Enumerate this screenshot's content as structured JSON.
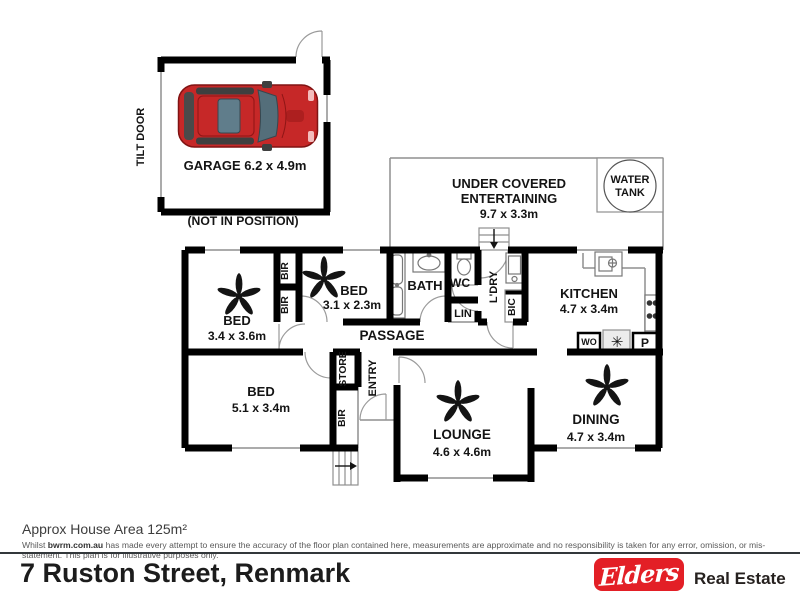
{
  "colors": {
    "wall": "#000000",
    "thin_line": "#8f8f8f",
    "car_red": "#c62828",
    "brand_red": "#e31f26",
    "divider": "#33383b"
  },
  "garage": {
    "label": "GARAGE 6.2 x 4.9m",
    "door": "TILT DOOR",
    "note": "(NOT IN POSITION)"
  },
  "outdoor": {
    "entertaining_line1": "UNDER COVERED",
    "entertaining_line2": "ENTERTAINING",
    "entertaining_dims": "9.7 x 3.3m",
    "water_tank_line1": "WATER",
    "water_tank_line2": "TANK"
  },
  "rooms": {
    "bed1_name": "BED",
    "bed1_dims": "3.4 x 3.6m",
    "bed2_name": "BED",
    "bed2_dims": "3.1 x 2.3m",
    "bed3_name": "BED",
    "bed3_dims": "5.1 x 3.4m",
    "lounge_name": "LOUNGE",
    "lounge_dims": "4.6 x 4.6m",
    "dining_name": "DINING",
    "dining_dims": "4.7 x 3.4m",
    "kitchen_name": "KITCHEN",
    "kitchen_dims": "4.7 x 3.4m",
    "bath": "BATH",
    "wc": "WC",
    "lin": "LIN",
    "ldry": "L'DRY",
    "bic": "BIC",
    "passage": "PASSAGE",
    "entry": "ENTRY",
    "store": "STORE",
    "bir_a": "BIR",
    "bir_b": "BIR",
    "bir_c": "BIR",
    "wall_oven": "WO",
    "pantry": "P",
    "appliance_star": "✳"
  },
  "footer": {
    "area": "Approx House Area 125m²",
    "disclaimer_prefix": "Whilst ",
    "disclaimer_site": "bwrm.com.au",
    "disclaimer_rest": " has made every attempt to ensure the accuracy of the floor plan contained here, measurements are approximate and no responsibility is taken for any error, omission, or mis-statement. This plan is for illustrative purposes only.",
    "address": "7 Ruston Street, Renmark",
    "brand_script": "Elders",
    "brand_suffix": "Real Estate"
  }
}
